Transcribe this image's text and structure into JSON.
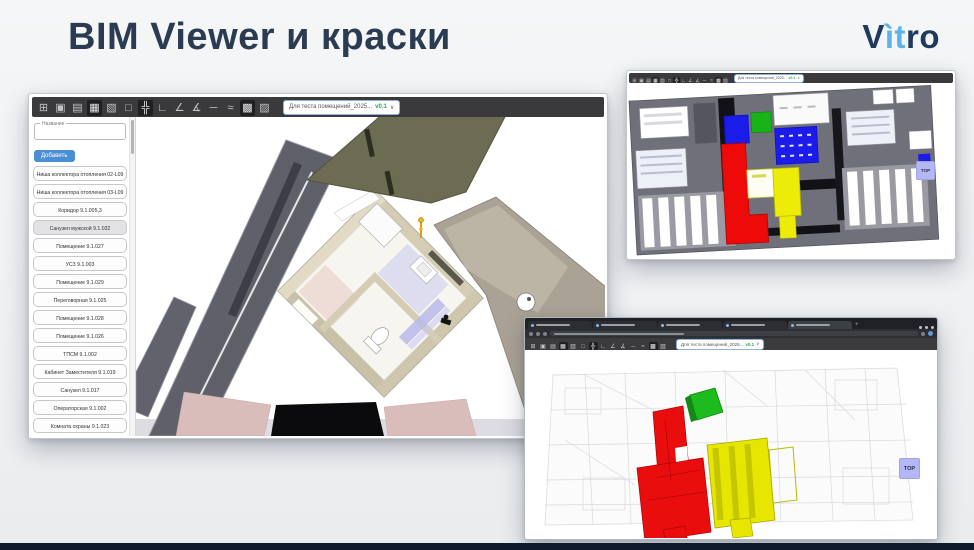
{
  "slide": {
    "title": "BIM Viewer и краски",
    "logo": {
      "v": "V",
      "it": "ìt",
      "ro": "ro"
    }
  },
  "colors": {
    "title_navy": "#2b3b52",
    "logo_lightblue": "#5eb4e8",
    "accent_blue": "#4a8fd4",
    "version_green": "#2ea158",
    "room_red": "#ea0d0d",
    "room_yellow": "#e6e600",
    "room_green": "#1bb41b",
    "room_blue": "#1b1bea",
    "view_cube_lavender": "#b3b7f5"
  },
  "viewer": {
    "toolbar": {
      "model_selector": "Для теста помещений_2025...",
      "version": "v0.1",
      "chevron": "∨",
      "icons": [
        {
          "name": "fit-view",
          "glyph": "⊞"
        },
        {
          "name": "select-object",
          "glyph": "▣"
        },
        {
          "name": "hide-object",
          "glyph": "▤"
        },
        {
          "name": "section-box",
          "glyph": "▦",
          "active": true
        },
        {
          "name": "clip-plane",
          "glyph": "▧"
        },
        {
          "name": "wireframe",
          "glyph": "□"
        },
        {
          "name": "move-axes",
          "glyph": "╬",
          "active": true
        },
        {
          "name": "measure-corner",
          "glyph": "∟"
        },
        {
          "name": "measure-angle",
          "glyph": "∠"
        },
        {
          "name": "measure-angle-open",
          "glyph": "∡"
        },
        {
          "name": "measure-line",
          "glyph": "─"
        },
        {
          "name": "measure-curve",
          "glyph": "≈"
        },
        {
          "name": "screenshot",
          "glyph": "▩",
          "active": true
        },
        {
          "name": "paint-brush",
          "glyph": "▨"
        }
      ]
    },
    "sidebar": {
      "field_label": "Название",
      "add_button": "Добавить",
      "item_dash": "-",
      "items": [
        {
          "label": "Ниша коллектора отопления 02-L09"
        },
        {
          "label": "Ниша коллектора отопления 03-L09"
        },
        {
          "label": "Коридор 9.1.005,3"
        },
        {
          "label": "Санузел мужской 9.1.032",
          "selected": true
        },
        {
          "label": "Помещение 9.1.027"
        },
        {
          "label": "УСЗ 9.1.003"
        },
        {
          "label": "Помещение 9.1.029"
        },
        {
          "label": "Переговорная 9.1.025"
        },
        {
          "label": "Помещение 9.1.028"
        },
        {
          "label": "Помещение 9.1.026"
        },
        {
          "label": "ТПСМ 9.1.002"
        },
        {
          "label": "Кабинет Заместителя 9.1.019"
        },
        {
          "label": "Санузел 9.1.017"
        },
        {
          "label": "Операторская 9.1.002"
        },
        {
          "label": "Комната охраны 9.1.023"
        }
      ]
    }
  },
  "top_right_window": {
    "view_cube": "TOP"
  },
  "bottom_right_window": {
    "view_cube": "TOP"
  }
}
